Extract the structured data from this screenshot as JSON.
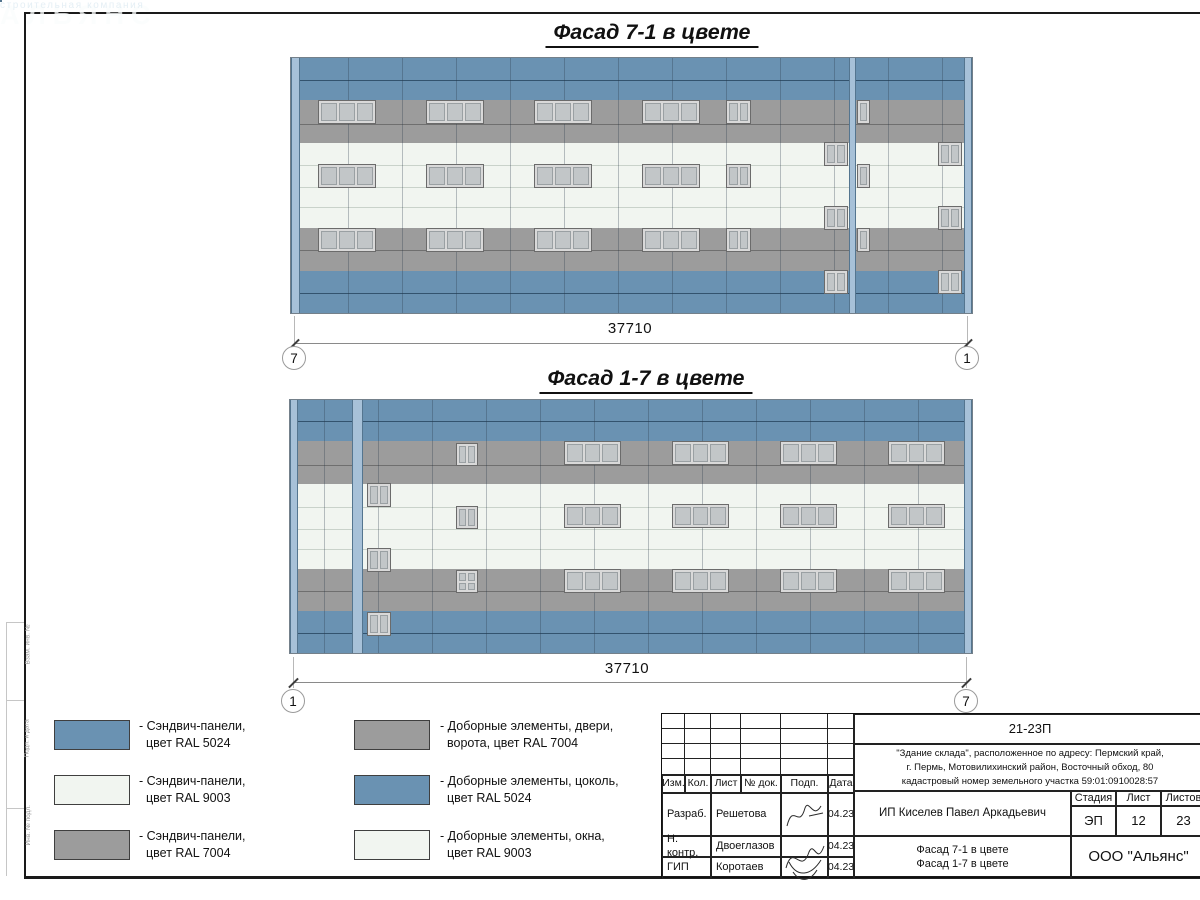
{
  "colors": {
    "blue": "#6a92b2",
    "blue_line": "#33536e",
    "gray": "#9c9c9c",
    "gray_line": "#6f6f6f",
    "white": "#f1f5f0",
    "white_line": "#c9d2ca",
    "pilaster": "#a7c1d8",
    "pilaster_edge": "#54758f",
    "window_frame": "#d9d9d9",
    "window_pane": "#c2c6c8",
    "ground": "#141414"
  },
  "facades": [
    {
      "name": "facade-7-1",
      "title": "Фасад 7-1 в цвете",
      "title_cx": 652,
      "title_y": 20,
      "box": {
        "x": 291,
        "y": 58,
        "w": 681,
        "h": 255
      },
      "joint_start": 294,
      "bands": [
        {
          "color": "blue",
          "y": 58,
          "h": 42,
          "lines": [
            22
          ]
        },
        {
          "color": "gray",
          "y": 100,
          "h": 43,
          "lines": [
            24
          ]
        },
        {
          "color": "white",
          "y": 143,
          "h": 85,
          "lines": [
            22,
            44,
            64
          ]
        },
        {
          "color": "gray",
          "y": 228,
          "h": 43,
          "lines": [
            22
          ]
        },
        {
          "color": "blue",
          "y": 271,
          "h": 42,
          "lines": [
            22
          ]
        }
      ],
      "pilasters": [
        {
          "x": 291,
          "w": 9
        },
        {
          "x": 849,
          "w": 7
        },
        {
          "x": 964,
          "w": 8
        }
      ],
      "tabs": [
        {
          "x": 276,
          "y": 85,
          "w": 16,
          "h": 6
        }
      ],
      "windows": [
        {
          "x": 318,
          "y": 100,
          "w": 58,
          "h": 24,
          "panes": 3
        },
        {
          "x": 426,
          "y": 100,
          "w": 58,
          "h": 24,
          "panes": 3
        },
        {
          "x": 534,
          "y": 100,
          "w": 58,
          "h": 24,
          "panes": 3
        },
        {
          "x": 642,
          "y": 100,
          "w": 58,
          "h": 24,
          "panes": 3
        },
        {
          "x": 726,
          "y": 100,
          "w": 25,
          "h": 24,
          "panes": 2
        },
        {
          "x": 857,
          "y": 100,
          "w": 13,
          "h": 24,
          "panes": 1
        },
        {
          "x": 318,
          "y": 164,
          "w": 58,
          "h": 24,
          "panes": 3
        },
        {
          "x": 426,
          "y": 164,
          "w": 58,
          "h": 24,
          "panes": 3
        },
        {
          "x": 534,
          "y": 164,
          "w": 58,
          "h": 24,
          "panes": 3
        },
        {
          "x": 642,
          "y": 164,
          "w": 58,
          "h": 24,
          "panes": 3
        },
        {
          "x": 726,
          "y": 164,
          "w": 25,
          "h": 24,
          "panes": 2
        },
        {
          "x": 857,
          "y": 164,
          "w": 13,
          "h": 24,
          "panes": 1
        },
        {
          "x": 318,
          "y": 228,
          "w": 58,
          "h": 24,
          "panes": 3
        },
        {
          "x": 426,
          "y": 228,
          "w": 58,
          "h": 24,
          "panes": 3
        },
        {
          "x": 534,
          "y": 228,
          "w": 58,
          "h": 24,
          "panes": 3
        },
        {
          "x": 642,
          "y": 228,
          "w": 58,
          "h": 24,
          "panes": 3
        },
        {
          "x": 726,
          "y": 228,
          "w": 25,
          "h": 24,
          "panes": 2
        },
        {
          "x": 857,
          "y": 228,
          "w": 13,
          "h": 24,
          "panes": 1
        },
        {
          "x": 824,
          "y": 142,
          "w": 24,
          "h": 24,
          "panes": 2
        },
        {
          "x": 938,
          "y": 142,
          "w": 24,
          "h": 24,
          "panes": 2
        },
        {
          "x": 824,
          "y": 206,
          "w": 24,
          "h": 24,
          "panes": 2
        },
        {
          "x": 938,
          "y": 206,
          "w": 24,
          "h": 24,
          "panes": 2
        },
        {
          "x": 824,
          "y": 270,
          "w": 24,
          "h": 24,
          "panes": 2
        },
        {
          "x": 938,
          "y": 270,
          "w": 24,
          "h": 24,
          "panes": 2
        }
      ],
      "ground": {
        "x": 213,
        "y": 312,
        "w": 855,
        "h": 4
      },
      "steps": [
        {
          "x": 973,
          "y": 309,
          "w": 26,
          "h": 3
        }
      ],
      "dim": {
        "label": "37710",
        "y": 343,
        "x1": 294,
        "x2": 967,
        "label_cx": 630,
        "label_y": 320,
        "ext_top": 316,
        "ext_bottom": 349,
        "circle_cy": 358,
        "circles": [
          {
            "x": 294,
            "label": "7"
          },
          {
            "x": 967,
            "label": "1"
          }
        ]
      }
    },
    {
      "name": "facade-1-7",
      "title": "Фасад 1-7 в цвете",
      "title_cx": 646,
      "title_y": 366,
      "box": {
        "x": 290,
        "y": 400,
        "w": 682,
        "h": 253
      },
      "joint_start": 324,
      "bands": [
        {
          "color": "blue",
          "y": 400,
          "h": 41,
          "lines": [
            21
          ]
        },
        {
          "color": "gray",
          "y": 441,
          "h": 43,
          "lines": [
            24
          ]
        },
        {
          "color": "white",
          "y": 484,
          "h": 85,
          "lines": [
            23,
            45,
            65
          ]
        },
        {
          "color": "gray",
          "y": 569,
          "h": 42,
          "lines": [
            22
          ]
        },
        {
          "color": "blue",
          "y": 611,
          "h": 42,
          "lines": [
            22
          ]
        }
      ],
      "pilasters": [
        {
          "x": 290,
          "w": 8
        },
        {
          "x": 352,
          "w": 11
        },
        {
          "x": 964,
          "w": 8
        }
      ],
      "tabs": [
        {
          "x": 970,
          "y": 419,
          "w": 14,
          "h": 6
        }
      ],
      "windows": [
        {
          "x": 564,
          "y": 441,
          "w": 57,
          "h": 24,
          "panes": 3
        },
        {
          "x": 672,
          "y": 441,
          "w": 57,
          "h": 24,
          "panes": 3
        },
        {
          "x": 780,
          "y": 441,
          "w": 57,
          "h": 24,
          "panes": 3
        },
        {
          "x": 888,
          "y": 441,
          "w": 57,
          "h": 24,
          "panes": 3
        },
        {
          "x": 456,
          "y": 443,
          "w": 22,
          "h": 23,
          "panes": 2
        },
        {
          "x": 564,
          "y": 504,
          "w": 57,
          "h": 24,
          "panes": 3
        },
        {
          "x": 672,
          "y": 504,
          "w": 57,
          "h": 24,
          "panes": 3
        },
        {
          "x": 780,
          "y": 504,
          "w": 57,
          "h": 24,
          "panes": 3
        },
        {
          "x": 888,
          "y": 504,
          "w": 57,
          "h": 24,
          "panes": 3
        },
        {
          "x": 456,
          "y": 506,
          "w": 22,
          "h": 23,
          "panes": 2
        },
        {
          "x": 564,
          "y": 569,
          "w": 57,
          "h": 24,
          "panes": 3
        },
        {
          "x": 672,
          "y": 569,
          "w": 57,
          "h": 24,
          "panes": 3
        },
        {
          "x": 780,
          "y": 569,
          "w": 57,
          "h": 24,
          "panes": 3
        },
        {
          "x": 888,
          "y": 569,
          "w": 57,
          "h": 24,
          "panes": 3
        },
        {
          "x": 456,
          "y": 570,
          "w": 22,
          "h": 23,
          "panes": 4,
          "split": true
        },
        {
          "x": 367,
          "y": 483,
          "w": 24,
          "h": 24,
          "panes": 2
        },
        {
          "x": 367,
          "y": 548,
          "w": 24,
          "h": 24,
          "panes": 2
        },
        {
          "x": 367,
          "y": 612,
          "w": 24,
          "h": 24,
          "panes": 2
        }
      ],
      "ground": {
        "x": 213,
        "y": 653,
        "w": 855,
        "h": 4
      },
      "steps": [
        {
          "x": 263,
          "y": 650,
          "w": 27,
          "h": 3
        },
        {
          "x": 332,
          "y": 650,
          "w": 21,
          "h": 3
        }
      ],
      "dim": {
        "label": "37710",
        "y": 682,
        "x1": 293,
        "x2": 966,
        "label_cx": 627,
        "label_y": 660,
        "ext_top": 657,
        "ext_bottom": 688,
        "circle_cy": 701,
        "circles": [
          {
            "x": 293,
            "label": "1"
          },
          {
            "x": 966,
            "label": "7"
          }
        ]
      },
      "watermark": true
    }
  ],
  "watermark": {
    "brand": "АЛЬЯНС",
    "subtitle": "строительная компания",
    "triangle": {
      "x": 531,
      "y": 417,
      "w": 34,
      "h": 58
    },
    "brand_pos": {
      "x": 566,
      "y": 434
    },
    "subtitle_pos": {
      "x": 576,
      "y": 464
    }
  },
  "legend": {
    "items": [
      {
        "color": "blue",
        "line1": "- Сэндвич-панели,",
        "line2": "цвет RAL 5024"
      },
      {
        "color": "white",
        "line1": "- Сэндвич-панели,",
        "line2": "цвет RAL 9003"
      },
      {
        "color": "gray",
        "line1": "- Сэндвич-панели,",
        "line2": "цвет RAL 7004"
      },
      {
        "color": "gray",
        "line1": "- Доборные элементы, двери,",
        "line2": "ворота, цвет RAL 7004"
      },
      {
        "color": "blue",
        "line1": "- Доборные элементы, цоколь,",
        "line2": "цвет RAL 5024"
      },
      {
        "color": "white",
        "line1": "- Доборные элементы, окна,",
        "line2": "цвет RAL 9003"
      }
    ]
  },
  "title_block": {
    "code": "21-23П",
    "address_lines": [
      "\"Здание склада\", расположенное по адресу: Пермский край,",
      "г. Пермь, Мотовилихинский район, Восточный обход, 80",
      "кадастровый номер земельного участка 59:01:0910028:57"
    ],
    "header_cols": [
      "Изм.",
      "Кол.",
      "Лист",
      "№ док.",
      "Подп.",
      "Дата"
    ],
    "rows": [
      {
        "role": "Разраб.",
        "name": "Решетова",
        "date": "04.23"
      },
      {
        "role": "Н. контр.",
        "name": "Двоеглазов",
        "date": "04.23"
      },
      {
        "role": "ГИП",
        "name": "Коротаев",
        "date": "04.23"
      }
    ],
    "client": "ИП Киселев Павел Аркадьевич",
    "stage_label": "Стадия",
    "sheet_label": "Лист",
    "sheets_label": "Листов",
    "stage": "ЭП",
    "sheet": "12",
    "sheets": "23",
    "subject_line1": "Фасад 7-1 в цвете",
    "subject_line2": "Фасад 1-7 в цвете",
    "company": "ООО \"Альянс\""
  },
  "margin_labels": [
    "Взам. инв. №",
    "Подп. и дата",
    "Инв. № подл."
  ]
}
